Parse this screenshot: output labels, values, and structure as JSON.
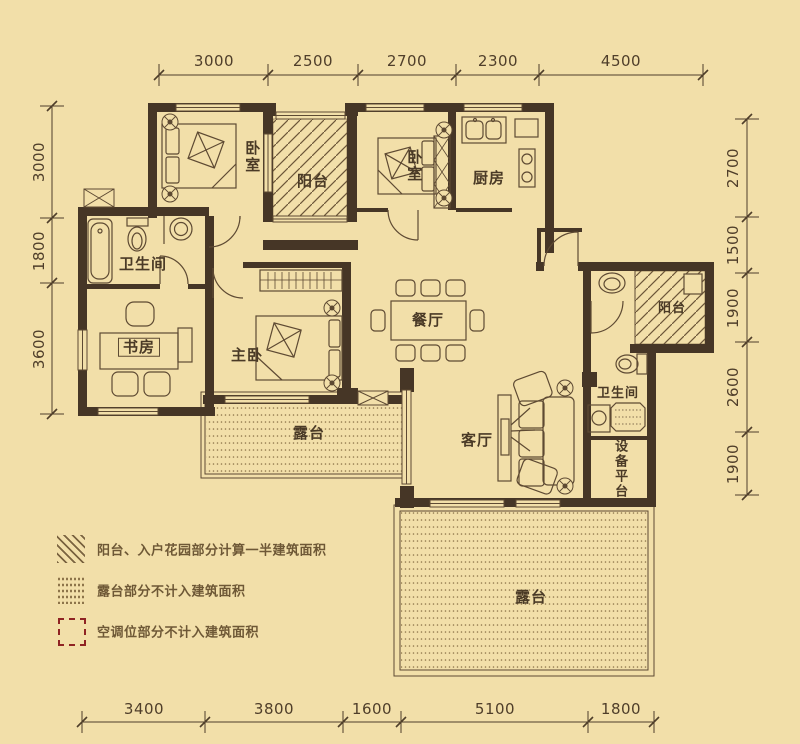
{
  "plan": {
    "rooms": {
      "bedroom1": "卧室",
      "balcony1": "阳台",
      "bedroom2": "卧室",
      "kitchen": "厨房",
      "bathroom1": "卫生间",
      "study": "书房",
      "master_bedroom": "主卧",
      "dining": "餐厅",
      "balcony2": "阳台",
      "bathroom2": "卫生间",
      "living": "客厅",
      "terrace1": "露台",
      "equipment_platform": "设备平台",
      "terrace2": "露台"
    },
    "dimensions_mm": {
      "top": [
        "3000",
        "2500",
        "2700",
        "2300",
        "4500"
      ],
      "bottom": [
        "3400",
        "3800",
        "1600",
        "5100",
        "1800"
      ],
      "left": [
        "3000",
        "1800",
        "3600"
      ],
      "right": [
        "2700",
        "1500",
        "1900",
        "2600",
        "1900"
      ]
    },
    "legend": [
      {
        "symbol": "diagonal-hatch",
        "label": "阳台、入户花园部分计算一半建筑面积"
      },
      {
        "symbol": "dotted-fill",
        "label": "露台部分不计入建筑面积"
      },
      {
        "symbol": "red-dashed-box",
        "label": "空调位部分不计入建筑面积"
      }
    ],
    "colors": {
      "background": "#f2dfa9",
      "wall": "#463626",
      "line": "#5e4a33",
      "dimension": "#4f3e2a",
      "legend_red": "#8f2323"
    }
  }
}
